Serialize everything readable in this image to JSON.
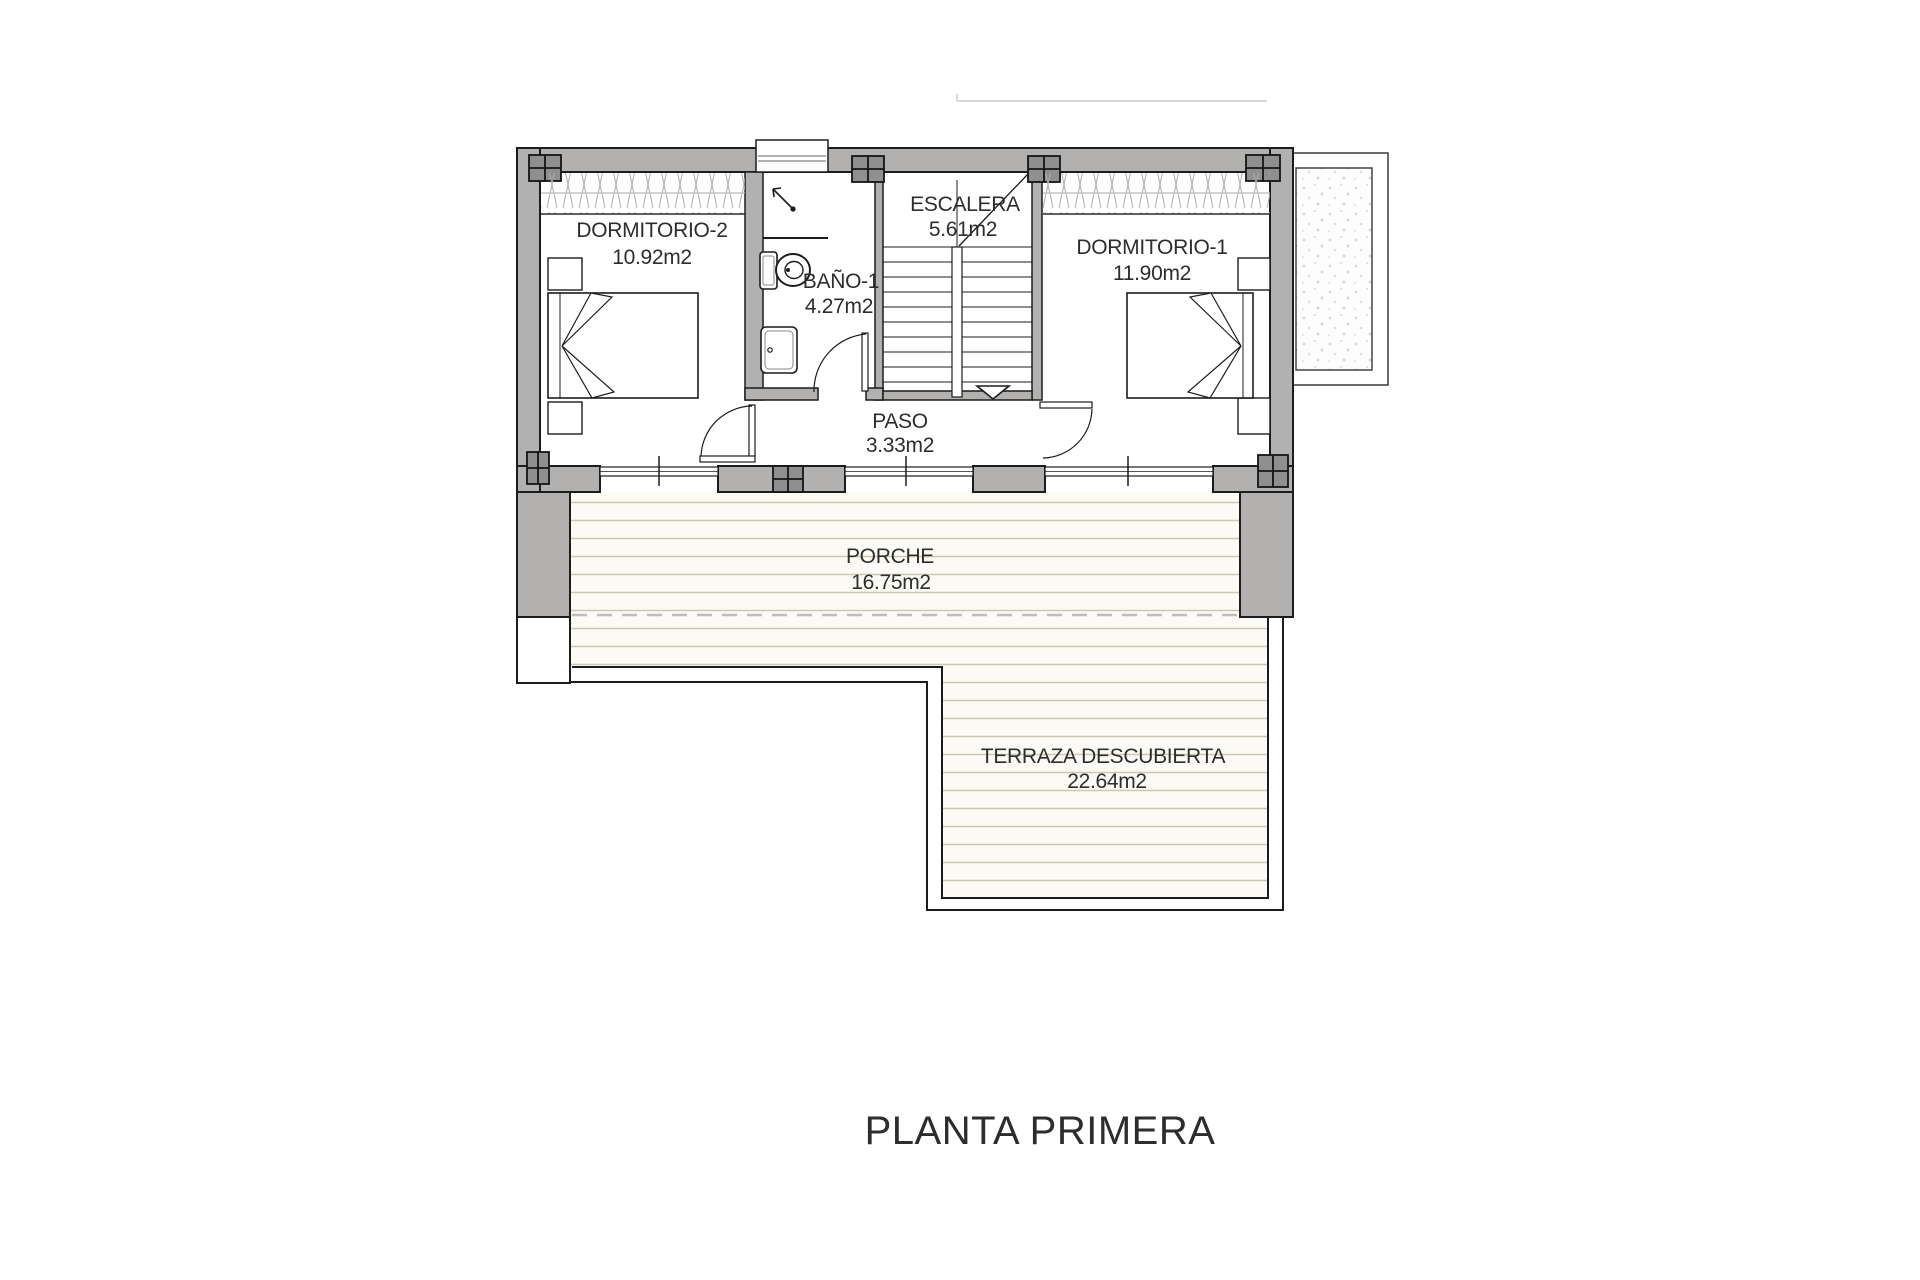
{
  "title": "PLANTA PRIMERA",
  "rooms": {
    "dormitorio2": {
      "name": "DORMITORIO-2",
      "area": "10.92m2"
    },
    "bano1": {
      "name": "BAÑO-1",
      "area": "4.27m2"
    },
    "escalera": {
      "name": "ESCALERA",
      "area": "5.61m2"
    },
    "dormitorio1": {
      "name": "DORMITORIO-1",
      "area": "11.90m2"
    },
    "paso": {
      "name": "PASO",
      "area": "3.33m2"
    },
    "porche": {
      "name": "PORCHE",
      "area": "16.75m2"
    },
    "terraza": {
      "name": "TERRAZA DESCUBIERTA",
      "area": "22.64m2"
    }
  },
  "colors": {
    "wall_fill": "#b3b1b0",
    "pillar_fill": "#8f8f8f",
    "outline": "#1c1c1c",
    "deck_line": "#ccc9b2",
    "deck_bg": "#fbfaf4",
    "stipple_dot": "#d6d6d6",
    "text": "#2d2d2d"
  }
}
